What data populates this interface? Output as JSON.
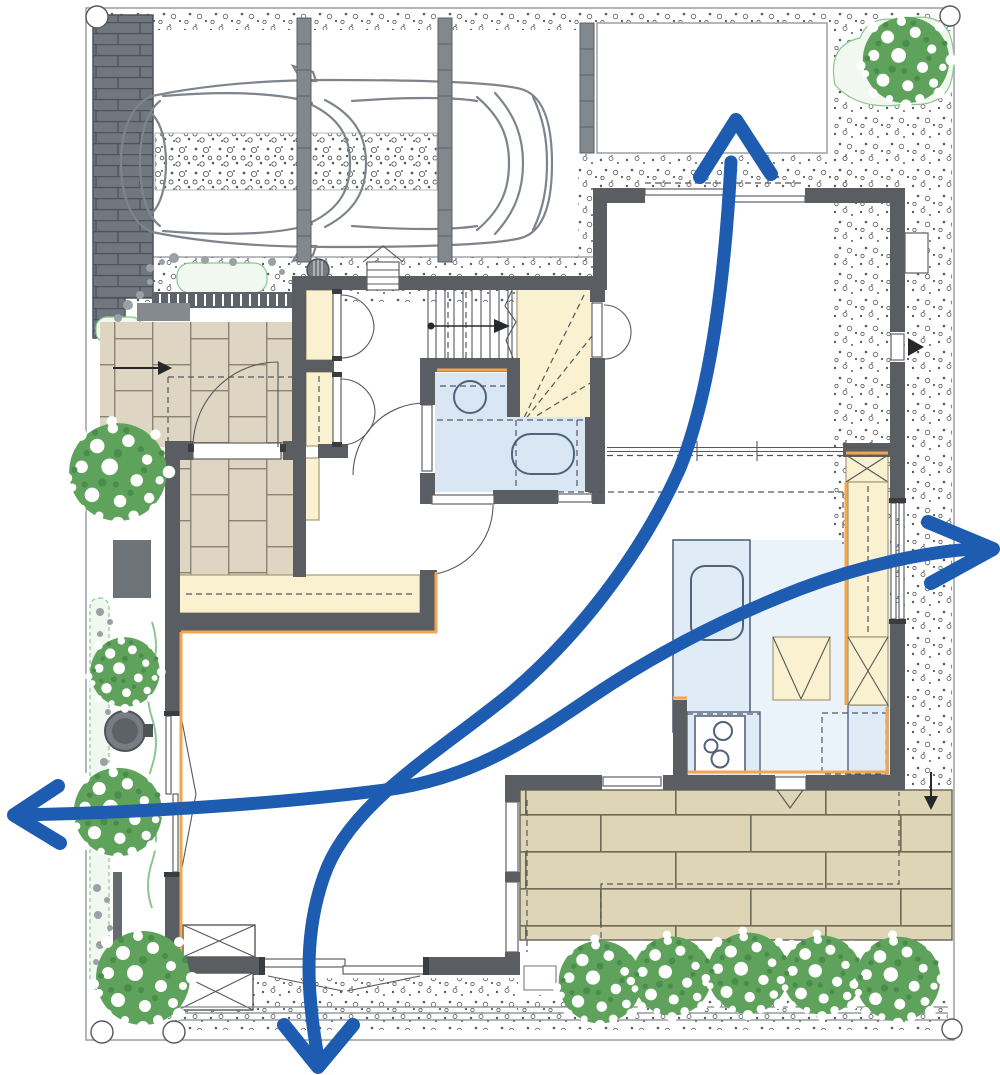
{
  "figure": {
    "type": "architectural-floor-plan",
    "content": "first-floor site plan of a house with carport, garden trees, brick terrace and blue airflow arrows",
    "visible_text": []
  },
  "colors": {
    "wall": "#5a5e63",
    "line": "#8d9196",
    "ink": "#26282b",
    "tile": "#ded6c2",
    "tilej": "#8a8272",
    "cream": "#faf1d0",
    "creamline": "#a59a76",
    "blue": "#d9e7f5",
    "bluefloor": "#eaf2fa",
    "bluedeep": "#51637a",
    "brick": "#ded4b6",
    "brickline": "#6d6a56",
    "tree": "#5ea25c",
    "treedark": "#4a8c4b",
    "hedge": "#f1f8ef",
    "hedgeline": "#8cc690",
    "arrow": "#1d5cb0",
    "orange": "#f2a64d",
    "dot": "#585c60",
    "car": "#7e848b",
    "post": "#83888d"
  },
  "elements": {
    "airflow_arrows": [
      {
        "direction": "up"
      },
      {
        "direction": "down"
      },
      {
        "direction": "left"
      },
      {
        "direction": "right"
      }
    ],
    "symbols": [
      "car-top-view",
      "carport-posts",
      "brick-wall",
      "gravel-stipple",
      "entrance-tile-floor",
      "closets",
      "straight-stair",
      "winder-stair",
      "washbasin",
      "toilet",
      "kitchen-island-sink",
      "gas-stove",
      "refrigerator-space",
      "pantry-shelf",
      "terrace-brick-paving",
      "step-bench",
      "trees",
      "garden-stones",
      "planter-pot",
      "site-boundary-pins",
      "fence-lines",
      "sliding-windows",
      "swing-doors"
    ],
    "tree_count": 10
  }
}
